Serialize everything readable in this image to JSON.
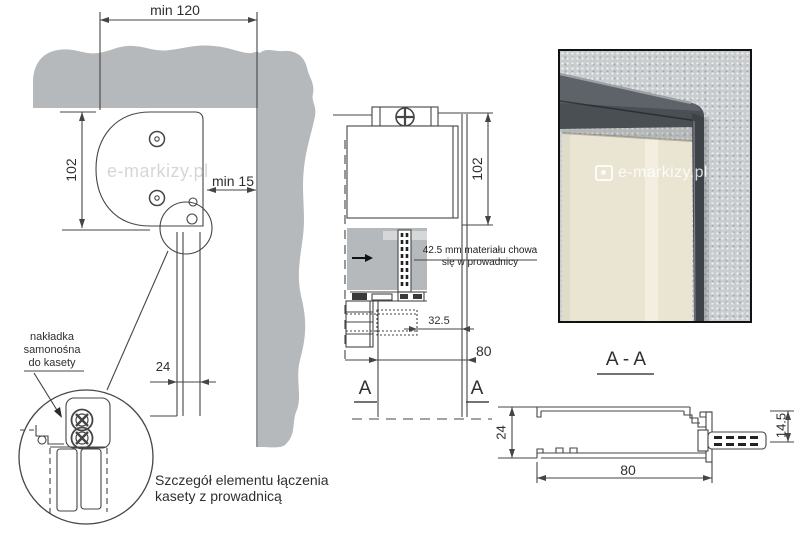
{
  "left_drawing": {
    "dim_min_width": "min 120",
    "dim_cassette_height": "102",
    "dim_min_side": "min 15",
    "dim_guide_depth": "24",
    "watermark": "e-markizy.pl",
    "cover_label_line1": "nakładka",
    "cover_label_line2": "samonośna",
    "cover_label_line3": "do kasety",
    "caption_line1": "Szczegół elementu łączenia",
    "caption_line2": "kasety z prowadnicą"
  },
  "middle_drawing": {
    "dim_cassette_height": "102",
    "note_line1": "42.5 mm materiału chowa",
    "note_line2": "się w prowadnicy",
    "dim_fabric_offset": "32.5",
    "dim_guide_width": "80",
    "section_marker_left": "A",
    "section_marker_right": "A"
  },
  "section_aa": {
    "title": "A - A",
    "dim_depth": "24",
    "dim_width": "80",
    "dim_connector_height": "14.5"
  },
  "photo": {
    "watermark": "e-markizy.pl"
  },
  "colors": {
    "wall_gray": "#b6b9bb",
    "wall_gray_light": "#d5d8d9",
    "line": "#454545",
    "photo_wall": "#c9cdcf",
    "fabric": "#eae5d3",
    "fabric_highlight": "#f4f0e2",
    "profile_dark": "#42464b",
    "watermark_gray": "#c4c4c4"
  }
}
